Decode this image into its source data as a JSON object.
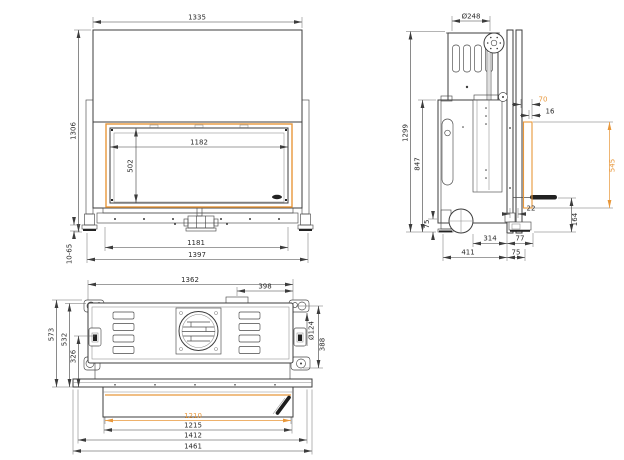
{
  "meta": {
    "background_color": "#ffffff",
    "line_color": "#3c3c3c",
    "accent_color": "#e8973a"
  },
  "front_view": {
    "dims": {
      "body_width": "1335",
      "total_height": "1306",
      "glass_width": "1182",
      "glass_height": "502",
      "base_inner_width": "1181",
      "base_outer_width": "1397",
      "feet_adjust_range": "10-65"
    }
  },
  "side_view": {
    "dims": {
      "flue_diameter": "Ø248",
      "total_height": "1299",
      "body_height": "847",
      "top_offset": "70",
      "frame_thickness": "16",
      "door_lift_travel": "545",
      "bottom_gap": "22",
      "bottom_height": "164",
      "foot_height": "75",
      "duct_to_front": "314",
      "front_frame_depth": "77",
      "body_depth": "411",
      "front_depth": "75"
    }
  },
  "top_view": {
    "dims": {
      "body_width": "1362",
      "flue_to_side": "398",
      "total_depth": "573",
      "body_depth": "532",
      "front_depth": "326",
      "duct_diameter": "Ø124",
      "side_depth": "388",
      "glass_width": "1210",
      "door_width": "1215",
      "frame_width": "1412",
      "total_width": "1461"
    }
  }
}
